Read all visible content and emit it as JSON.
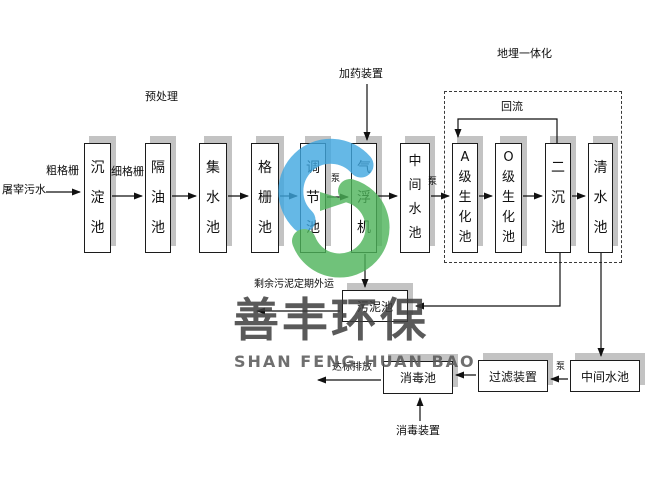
{
  "watermark": {
    "title_cn": "善丰环保",
    "title_en": "SHAN FENG HUAN BAO",
    "logo_blue": "#3fa7e0",
    "logo_green": "#4db45a"
  },
  "flow": {
    "source": "屠宰污水",
    "coarse_screen": "粗格栅",
    "fine_screen": "细格栅",
    "pretreatment": "预处理",
    "dosing_device": "加药装置",
    "buried_integration": "地埋一体化",
    "reflux": "回流",
    "pump": "泵",
    "excess_sludge_note": "剩余污泥定期外运",
    "discharge": "达标排放",
    "disinfection_device": "消毒装置",
    "tanks": {
      "sedimentation": "沉淀池",
      "oil_separation": "隔油池",
      "collection": "集水池",
      "grid": "格栅池",
      "regulation": "调节池",
      "air_flotation": "气浮机",
      "intermediate_1": "中间水池",
      "biochemical_a": "A级生化池",
      "biochemical_o": "O级生化池",
      "secondary_sedimentation": "二沉池",
      "clean_water": "清水池",
      "sludge": "污泥池",
      "disinfection": "消毒池",
      "filter": "过滤装置",
      "intermediate_2": "中间水池"
    }
  }
}
